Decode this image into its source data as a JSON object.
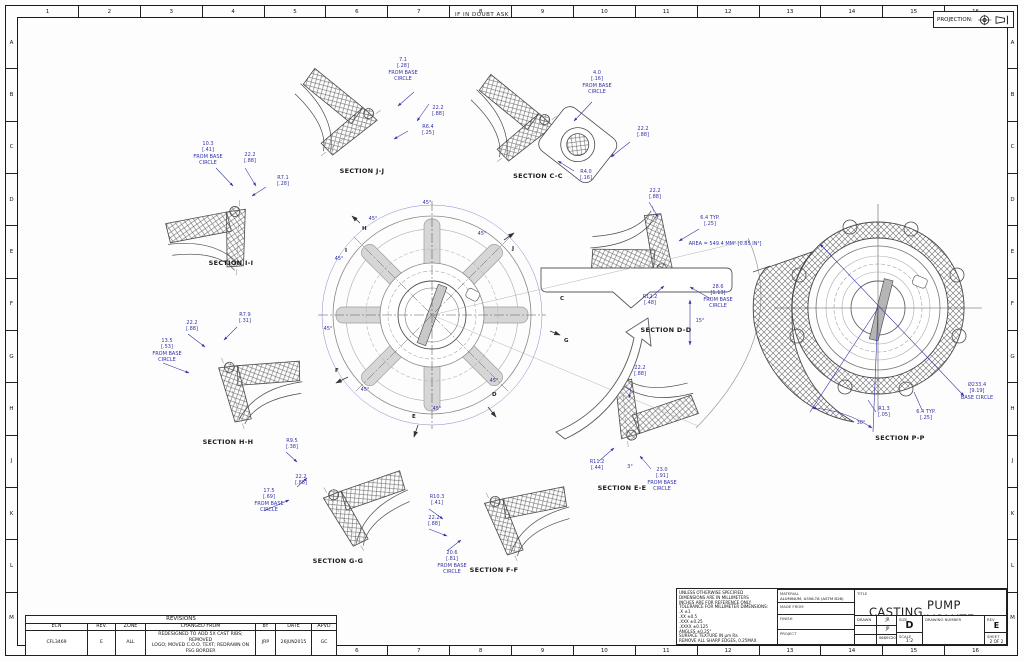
{
  "page": {
    "notice": "IF IN DOUBT ASK",
    "projection_label": "PROJECTION:"
  },
  "border": {
    "cols": [
      "1",
      "2",
      "3",
      "4",
      "5",
      "6",
      "7",
      "8",
      "9",
      "10",
      "11",
      "12",
      "13",
      "14",
      "15",
      "16"
    ],
    "rows": [
      "A",
      "B",
      "C",
      "D",
      "E",
      "F",
      "G",
      "H",
      "J",
      "K",
      "L",
      "M"
    ]
  },
  "sections": {
    "jj": {
      "label": "SECTION J-J",
      "offset": "7.1\n[.28]\nFROM BASE\nCIRCLE",
      "width": "22.2\n[.88]",
      "radius": "R6.4\n[.25]"
    },
    "cc": {
      "label": "SECTION C-C",
      "offset": "4.0\n[.16]\nFROM BASE\nCIRCLE",
      "width": "22.2\n[.88]",
      "radius": "R4.0\n[.16]"
    },
    "ii": {
      "label": "SECTION I-I",
      "offset": "10.3\n[.41]\nFROM BASE\nCIRCLE",
      "width": "22.2\n[.88]",
      "radius": "R7.1\n[.28]"
    },
    "dd": {
      "label": "SECTION D-D",
      "width": "22.2\n[.88]",
      "typ": "6.4  TYP.\n[.25]",
      "area": "AREA = 549.4 MM² [0.85 IN²]",
      "offset": "28.6\n[1.13]\nFROM BASE\nCIRCLE",
      "radius": "R12.2\n[.48]"
    },
    "hh": {
      "label": "SECTION H-H",
      "width": "22.2\n[.88]",
      "radius": "R7.9\n[.31]",
      "offset": "13.5\n[.53]\nFROM BASE\nCIRCLE"
    },
    "ee": {
      "label": "SECTION E-E",
      "width": "22.2\n[.88]",
      "radius": "R11.2\n[.44]",
      "angle": "3°",
      "offset": "23.0\n[.91]\nFROM BASE\nCIRCLE"
    },
    "gg": {
      "label": "SECTION G-G",
      "radius": "R9.5\n[.38]",
      "width": "22.2\n[.88]",
      "offset": "17.5\n[.69]\nFROM BASE\nCIRCLE"
    },
    "ff": {
      "label": "SECTION F-F",
      "radius": "R10.3\n[.41]",
      "width": "22.2\n[.88]",
      "offset": "20.6\n[.81]\nFROM BASE\nCIRCLE"
    },
    "pp": {
      "label": "SECTION P-P",
      "diameter": "Ø233.4\n[9.19]\nBASE CIRCLE",
      "radius": "R1.3\n[.05]",
      "typ": "6.4  TYP.\n[.25]",
      "angle": "30°"
    }
  },
  "center_view": {
    "angles": [
      "45°",
      "45°",
      "45°",
      "45°",
      "45°",
      "45°",
      "45°",
      "45°"
    ],
    "angle15": "15°",
    "letters": [
      "I",
      "H",
      "J",
      "C",
      "G",
      "D",
      "E",
      "F"
    ]
  },
  "revisions": {
    "title": "REVISIONS",
    "headers": [
      "ECN",
      "REV.",
      "ZONE",
      "CHANGED FROM",
      "BY",
      "DATE",
      "APVD"
    ],
    "row": {
      "ecn": "CFL3469",
      "rev": "E",
      "zone": "ALL",
      "changed_from": "REDESIGNED TO ADD 5X CAST RIBS; REMOVED\nLOGO; MOVED C.O.O. TEXT; REDRAWN ON FSG BORDER",
      "by": "JRP",
      "date": "26JUN2015",
      "apvd": "GC"
    }
  },
  "title_block": {
    "notes": "UNLESS OTHERWISE SPECIFIED\nDIMENSIONS ARE IN MILLIMETERS\nINCHES ARE FOR REFERENCE ONLY\nTOLERANCE FOR MILLIMETER DIMENSIONS:\n.X ±1\n.XX ±0.5\n.XXX ±0.25\n.XXXX ±0.125\nANGLES ±0.25°\nSURFACE TEXTURE IN µm Ra\nREMOVE ALL SHARP EDGES, 0.25MAX",
    "material_label": "MATERIAL",
    "material": "ALUMINUM, A356-T6 (ASTM B26)",
    "made_from_label": "MADE FROM",
    "finish_label": "FINISH",
    "project_label": "PROJECT",
    "title_label": "TITLE",
    "title_left": "CASTING,",
    "title_right": "PUMP VOLUTE",
    "drawn_label": "DRAWN",
    "drawn": "JR",
    "approved_label": "APPROVED",
    "approved": "JP",
    "date_label": "DATE",
    "date": "06DEC2012",
    "size_label": "SIZE",
    "size": "D",
    "scale_label": "SCALE",
    "scale": "1:2",
    "drawing_number_label": "DRAWING NUMBER",
    "rev_label": "REV",
    "rev": "E",
    "sheet_label": "SHEET",
    "sheet": "2 OF 2"
  }
}
